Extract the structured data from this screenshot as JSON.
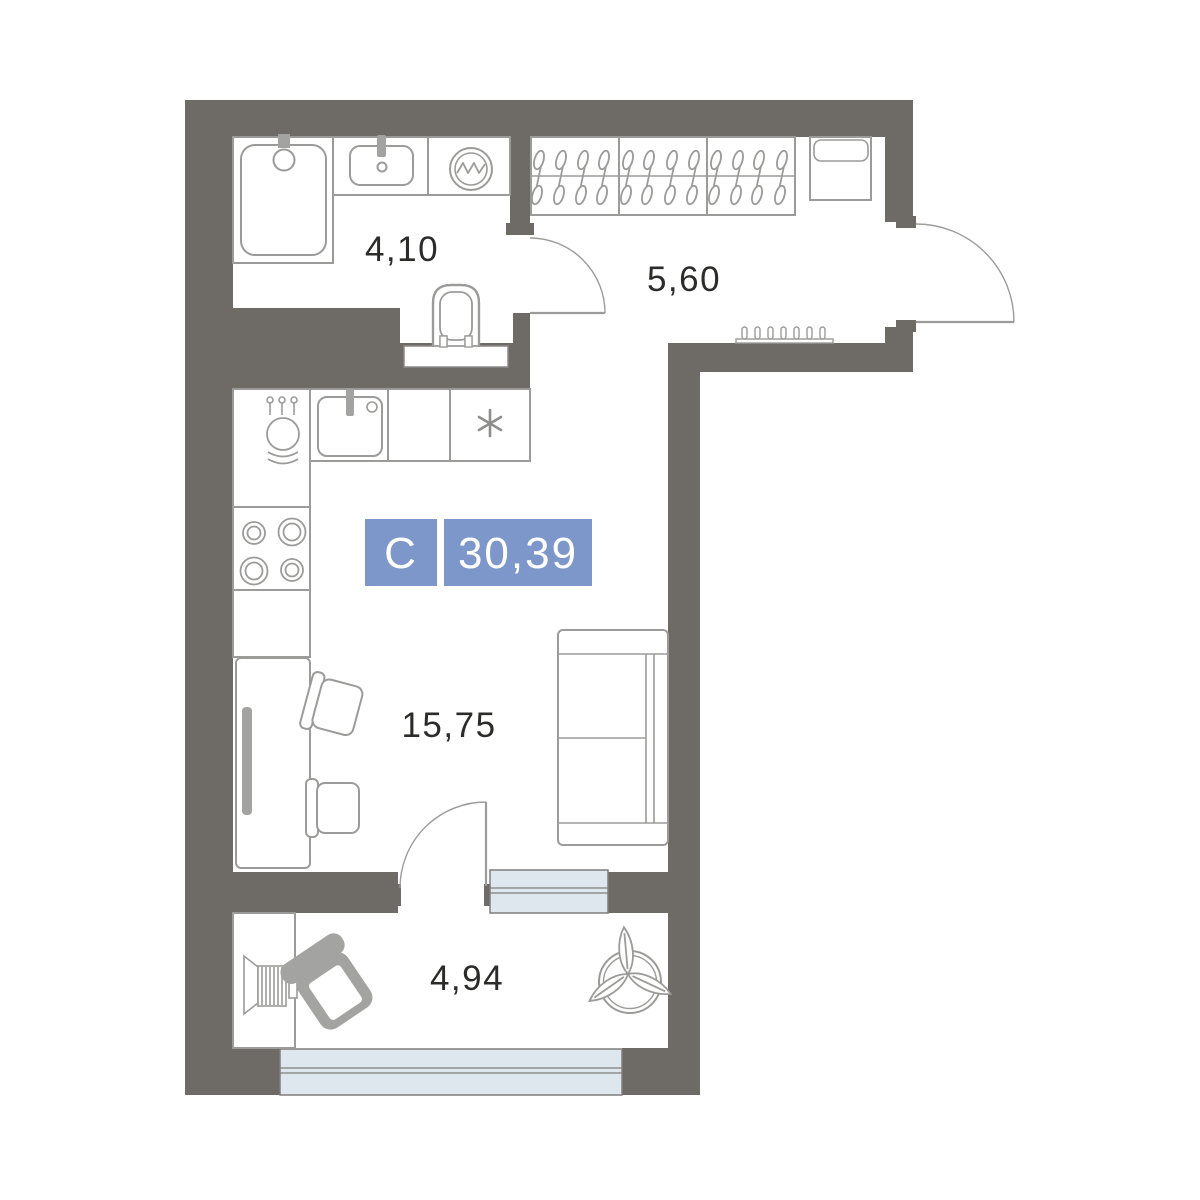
{
  "plan": {
    "title": "studio-floor-plan",
    "unit_type_label": "С",
    "total_area": "30,39",
    "rooms": [
      {
        "name": "bathroom",
        "area": "4,10"
      },
      {
        "name": "hallway",
        "area": "5,60"
      },
      {
        "name": "living-room",
        "area": "15,75"
      },
      {
        "name": "balcony",
        "area": "4,94"
      }
    ],
    "colors": {
      "wall": "#6E6B67",
      "furniture_line": "#9B9B99",
      "furniture_fill": "#A3A3A1",
      "glazing": "#DFE7EE",
      "glazing_border": "#7E7E7C",
      "accent_blue": "#7D97CA",
      "label_text": "#2B2B2A"
    }
  }
}
